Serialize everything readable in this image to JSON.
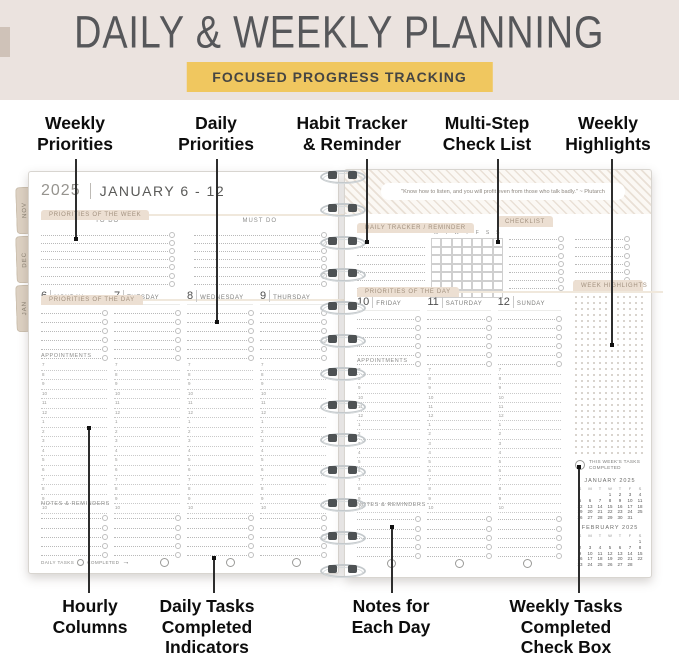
{
  "banner": {
    "title": "DAILY & WEEKLY PLANNING",
    "badge": "FOCUSED PROGRESS TRACKING"
  },
  "callouts": {
    "top": [
      {
        "lines": [
          "Weekly",
          "Priorities"
        ]
      },
      {
        "lines": [
          "Daily",
          "Priorities"
        ]
      },
      {
        "lines": [
          "Habit Tracker",
          "& Reminder"
        ]
      },
      {
        "lines": [
          "Multi-Step",
          "Check List"
        ]
      },
      {
        "lines": [
          "Weekly",
          "Highlights"
        ]
      }
    ],
    "bottom": [
      {
        "lines": [
          "Hourly",
          "Columns"
        ]
      },
      {
        "lines": [
          "Daily Tasks",
          "Completed",
          "Indicators"
        ]
      },
      {
        "lines": [
          "Notes for",
          "Each Day"
        ]
      },
      {
        "lines": [
          "Weekly Tasks",
          "Completed",
          "Check Box"
        ]
      }
    ]
  },
  "tabs": {
    "left": [
      "NOV",
      "DEC",
      "JAN"
    ],
    "right": [
      "FEB",
      "MAR",
      "APR",
      "MAY",
      "JUN",
      "JUL",
      "AUG",
      "SEP",
      "OCT",
      "NOV",
      "DEC"
    ]
  },
  "left_page": {
    "year": "2025",
    "week_title": "JANUARY 6 - 12",
    "week_block": {
      "title": "PRIORITIES OF THE WEEK",
      "col1": "TO DO",
      "col2": "MUST DO"
    },
    "day_block": {
      "title": "PRIORITIES OF THE DAY",
      "days": [
        {
          "num": "6",
          "name": "MONDAY"
        },
        {
          "num": "7",
          "name": "TUESDAY"
        },
        {
          "num": "8",
          "name": "WEDNESDAY"
        },
        {
          "num": "9",
          "name": "THURSDAY"
        }
      ]
    },
    "appointments_label": "APPOINTMENTS",
    "hours": [
      "7",
      "8",
      "9",
      "10",
      "11",
      "12",
      "1",
      "2",
      "3",
      "4",
      "5",
      "6",
      "7",
      "8",
      "9",
      "10"
    ],
    "notes_label": "NOTES & REMINDERS",
    "footer": {
      "label1": "DAILY TASKS",
      "label2": "COMPLETED",
      "arrow": "→"
    }
  },
  "right_page": {
    "quote": "\"Know how to listen, and you will profit even from those who talk badly.\" ~ Plutarch",
    "tracker": {
      "title": "DAILY TRACKER / REMINDER",
      "subtitle": "TASKS/ROUTINES/HABITS",
      "days": [
        "M",
        "T",
        "W",
        "T",
        "F",
        "S",
        "S"
      ]
    },
    "checklist": {
      "title": "CHECKLIST"
    },
    "day_block": {
      "title": "PRIORITIES OF THE DAY",
      "days": [
        {
          "num": "10",
          "name": "FRIDAY"
        },
        {
          "num": "11",
          "name": "SATURDAY"
        },
        {
          "num": "12",
          "name": "SUNDAY"
        }
      ]
    },
    "week_highlights_label": "WEEK HIGHLIGHTS",
    "appointments_label": "APPOINTMENTS",
    "hours": [
      "7",
      "8",
      "9",
      "10",
      "11",
      "12",
      "1",
      "2",
      "3",
      "4",
      "5",
      "6",
      "7",
      "8",
      "9",
      "10"
    ],
    "notes_label": "NOTES & REMINDERS",
    "weekly_tasks": {
      "lines": [
        "THIS WEEK'S TASKS",
        "COMPLETED"
      ]
    },
    "calendars": [
      {
        "title": "JANUARY",
        "year": "2025",
        "dow": [
          "S",
          "M",
          "T",
          "W",
          "T",
          "F",
          "S"
        ],
        "cells": [
          "",
          "",
          "",
          "1",
          "2",
          "3",
          "4",
          "5",
          "6",
          "7",
          "8",
          "9",
          "10",
          "11",
          "12",
          "13",
          "14",
          "15",
          "16",
          "17",
          "18",
          "19",
          "20",
          "21",
          "22",
          "23",
          "24",
          "25",
          "26",
          "27",
          "28",
          "29",
          "30",
          "31",
          ""
        ]
      },
      {
        "title": "FEBRUARY",
        "year": "2025",
        "dow": [
          "S",
          "M",
          "T",
          "W",
          "T",
          "F",
          "S"
        ],
        "cells": [
          "",
          "",
          "",
          "",
          "",
          "",
          "1",
          "2",
          "3",
          "4",
          "5",
          "6",
          "7",
          "8",
          "9",
          "10",
          "11",
          "12",
          "13",
          "14",
          "15",
          "16",
          "17",
          "18",
          "19",
          "20",
          "21",
          "22",
          "23",
          "24",
          "25",
          "26",
          "27",
          "28",
          ""
        ]
      }
    ]
  },
  "colors": {
    "banner_bg": "#ebe3df",
    "badge_bg": "#f0c75f",
    "title_text": "#56575a",
    "pill_bg": "#ecdfd2",
    "tab_bg": "#ddd1c2",
    "page_bg": "#ffffff",
    "callout_text": "#0d0d0d"
  }
}
